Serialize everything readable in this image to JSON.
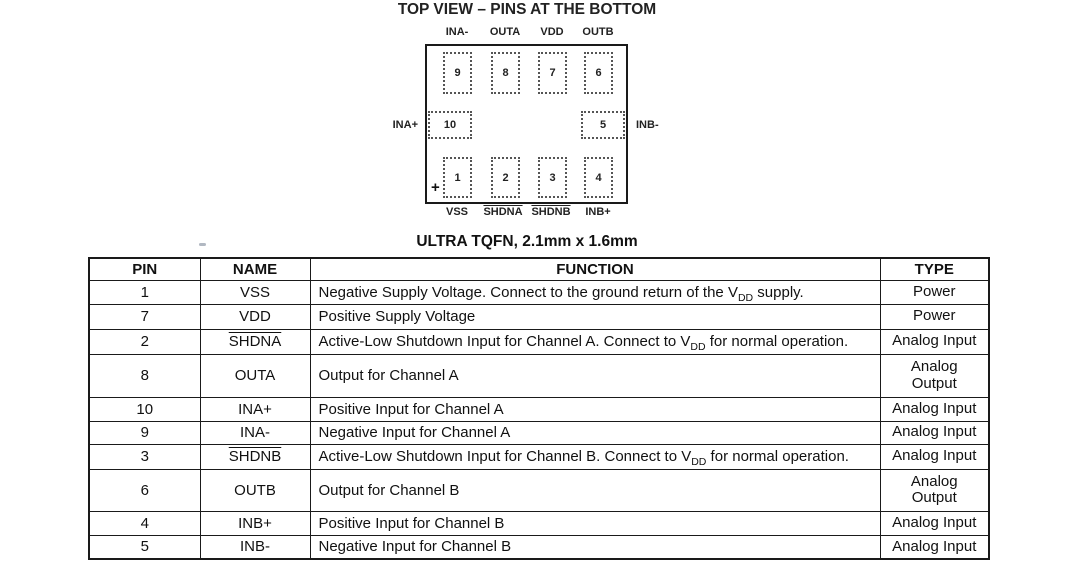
{
  "diagram": {
    "title": "TOP VIEW – PINS AT THE BOTTOM",
    "subtitle": "ULTRA TQFN, 2.1mm x 1.6mm",
    "plus_mark": "+",
    "top_pins": [
      {
        "num": "9",
        "label": "INA-"
      },
      {
        "num": "8",
        "label": "OUTA"
      },
      {
        "num": "7",
        "label": "VDD"
      },
      {
        "num": "6",
        "label": "OUTB"
      }
    ],
    "left_pin": {
      "num": "10",
      "label": "INA+"
    },
    "right_pin": {
      "num": "5",
      "label": "INB-"
    },
    "bottom_pins": [
      {
        "num": "1",
        "label": "VSS"
      },
      {
        "num": "2",
        "label": "SHDNA"
      },
      {
        "num": "3",
        "label": "SHDNB"
      },
      {
        "num": "4",
        "label": "INB+"
      }
    ]
  },
  "table": {
    "headers": [
      "PIN",
      "NAME",
      "FUNCTION",
      "TYPE"
    ],
    "rows": [
      {
        "pin": "1",
        "name": "VSS",
        "func_pre": "Negative Supply Voltage. Connect to the ground return of the V",
        "func_sub": "DD",
        "func_post": " supply.",
        "type": "Power"
      },
      {
        "pin": "7",
        "name": "VDD",
        "func_pre": "Positive Supply Voltage",
        "func_sub": "",
        "func_post": "",
        "type": "Power"
      },
      {
        "pin": "2",
        "name": "SHDNA",
        "func_pre": "Active-Low Shutdown Input for Channel A. Connect to V",
        "func_sub": "DD",
        "func_post": " for normal operation.",
        "type": "Analog Input"
      },
      {
        "pin": "8",
        "name": "OUTA",
        "func_pre": "Output for Channel A",
        "func_sub": "",
        "func_post": "",
        "type": "Analog\nOutput"
      },
      {
        "pin": "10",
        "name": "INA+",
        "func_pre": "Positive Input for Channel A",
        "func_sub": "",
        "func_post": "",
        "type": "Analog Input"
      },
      {
        "pin": "9",
        "name": "INA-",
        "func_pre": "Negative Input for Channel A",
        "func_sub": "",
        "func_post": "",
        "type": "Analog Input"
      },
      {
        "pin": "3",
        "name": "SHDNB",
        "func_pre": "Active-Low Shutdown Input for Channel B. Connect to V",
        "func_sub": "DD",
        "func_post": " for normal operation.",
        "type": "Analog Input"
      },
      {
        "pin": "6",
        "name": "OUTB",
        "func_pre": "Output for Channel B",
        "func_sub": "",
        "func_post": "",
        "type": "Analog\nOutput"
      },
      {
        "pin": "4",
        "name": "INB+",
        "func_pre": "Positive Input for Channel B",
        "func_sub": "",
        "func_post": "",
        "type": "Analog Input"
      },
      {
        "pin": "5",
        "name": "INB-",
        "func_pre": "Negative Input for Channel B",
        "func_sub": "",
        "func_post": "",
        "type": "Analog Input"
      }
    ]
  },
  "colors": {
    "ink": "#1a1a1a",
    "pin_dash": "#555555",
    "background": "#ffffff"
  }
}
